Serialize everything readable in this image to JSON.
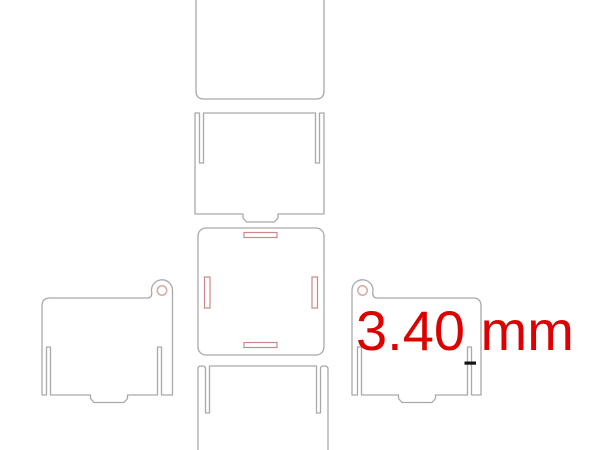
{
  "annotation": {
    "label": "3.40 mm",
    "color": "#dd0000"
  },
  "colors": {
    "outline": "#a9a9a9",
    "engraving": "#cc8888",
    "hole": "#d8a8a8",
    "marker": "#151515",
    "background": "#ffffff"
  },
  "panels": [
    {
      "id": "top-lid-panel"
    },
    {
      "id": "upper-side-panel"
    },
    {
      "id": "base-panel"
    },
    {
      "id": "left-side-panel"
    },
    {
      "id": "right-side-panel"
    },
    {
      "id": "lower-side-panel"
    }
  ],
  "measurement": {
    "value": "3.40 mm"
  }
}
